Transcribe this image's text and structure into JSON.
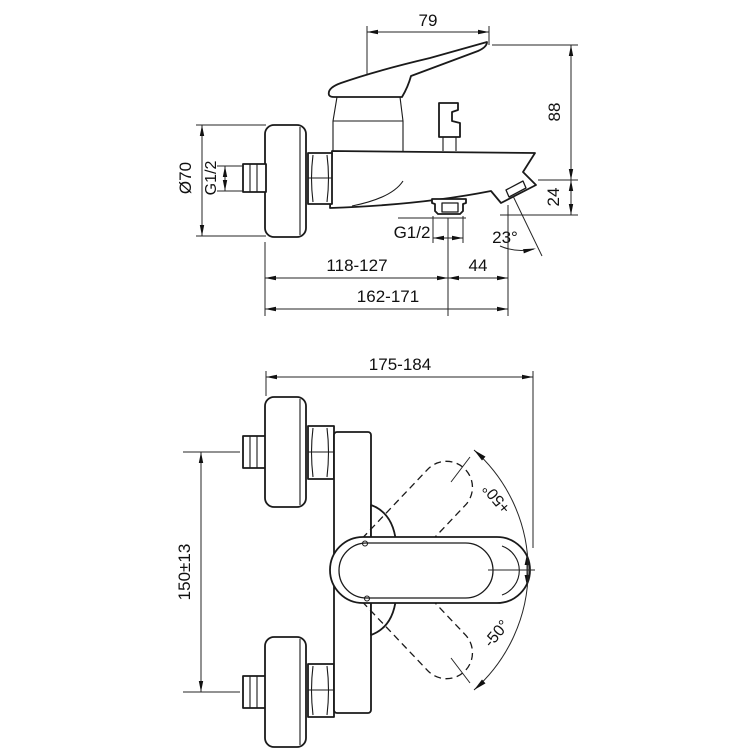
{
  "drawing": {
    "subject": "wall-mounted bath shower mixer tap dimensional drawing",
    "background_color": "#ffffff",
    "line_color": "#1a1a1a",
    "views": {
      "side": {
        "name": "side view",
        "dims": {
          "handle_length": "79",
          "overall_height": "88",
          "spout_drop": "24",
          "escutcheon_diameter": "Ø70",
          "inlet_thread": "G1/2",
          "outlet_thread": "G1/2",
          "spout_angle": "23°",
          "wall_to_outlet": "118-127",
          "outlet_to_spout_tip": "44",
          "wall_to_spout_tip": "162-171"
        }
      },
      "plan": {
        "name": "plan view",
        "dims": {
          "overall_width": "175-184",
          "connection_spacing": "150±13",
          "handle_swing_positive": "+50°",
          "handle_swing_negative": "-50°"
        }
      }
    }
  }
}
